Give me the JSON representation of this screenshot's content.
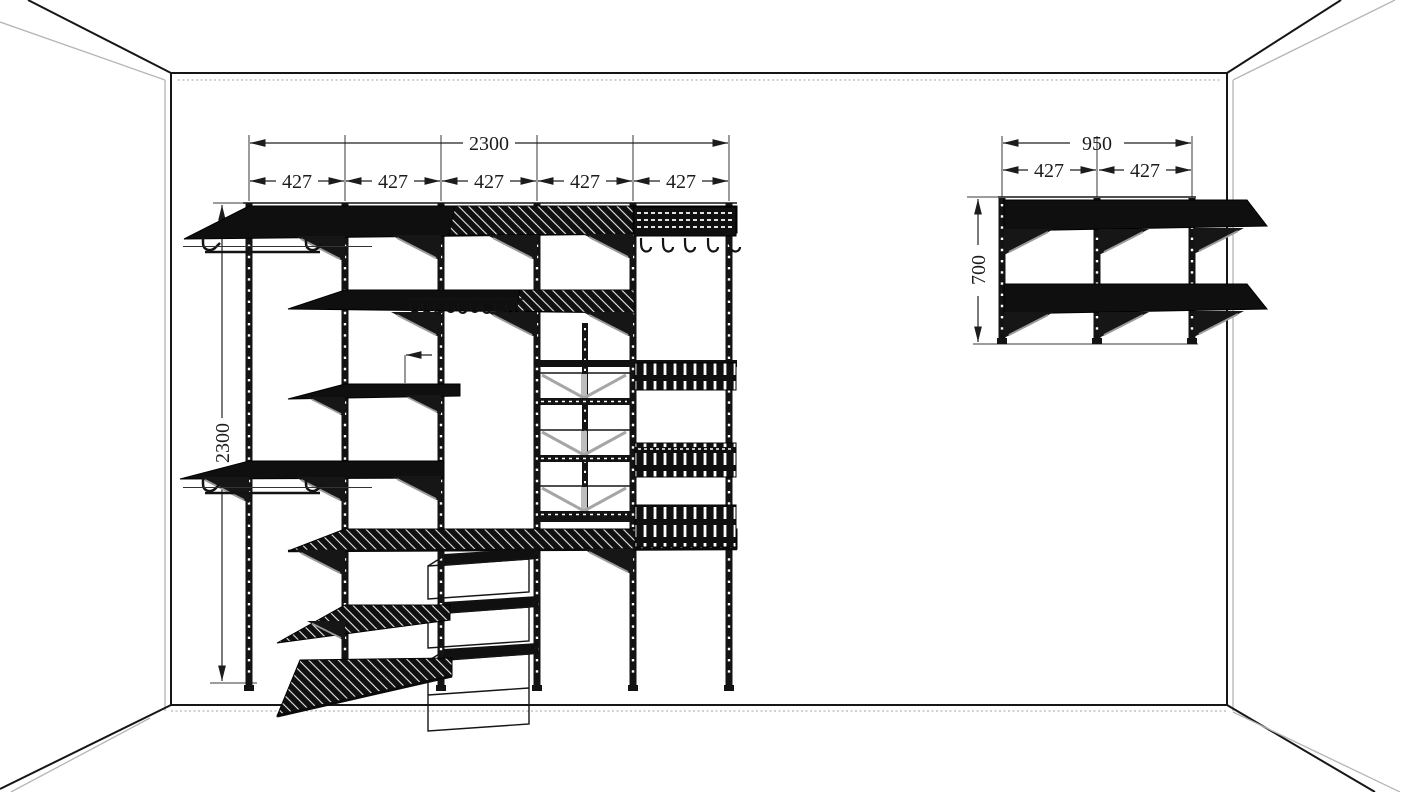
{
  "drawing": {
    "type": "closet-shelving-elevation",
    "colors": {
      "line": "#161616",
      "wall_gray": "#b5b5b5",
      "bracket_gray": "#9a9a9a",
      "background": "#ffffff"
    },
    "left_unit": {
      "width_total": "2300",
      "width_segments": [
        "427",
        "427",
        "427",
        "427",
        "427"
      ],
      "height_total": "2300"
    },
    "right_unit": {
      "width_total": "950",
      "width_segments": [
        "427",
        "427"
      ],
      "height_total": "700"
    }
  }
}
